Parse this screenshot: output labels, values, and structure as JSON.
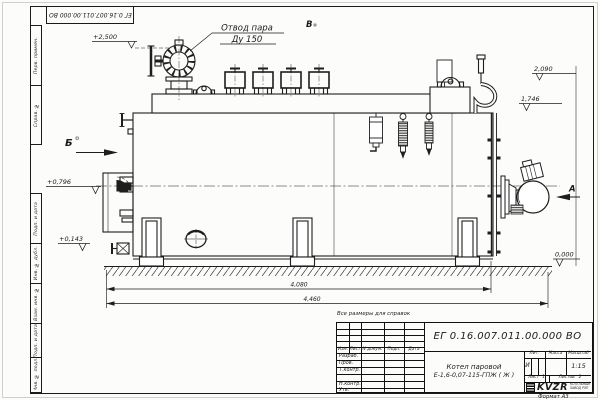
{
  "sheet": {
    "stamp_doc_number": "ЕГ 0.16.007.011.00.000  ВО",
    "reference_note": "Все размеры для справок",
    "format_label": "Формат А3"
  },
  "margin": {
    "col_top": [
      "Перв. примен.",
      "Справ. №"
    ],
    "col_bottom": [
      "Подп. и дата",
      "Инв. № дубл.",
      "Взам. инв. №",
      "Подп. и дата",
      "Инв. № подл."
    ]
  },
  "callout": {
    "line1": "Отвод пара",
    "line2": "Ду 150"
  },
  "views": {
    "b": "Б",
    "v": "В",
    "a": "А"
  },
  "elevations": {
    "valve_top": "+2,500",
    "dome_top": "2,090",
    "drum_top": "1,746",
    "door_axis": "+0,796",
    "low_point": "+0,143",
    "ground": "0,000"
  },
  "dimensions": {
    "boiler_length": "4,080",
    "overall_length": "4,460"
  },
  "title_block": {
    "doc_number": "ЕГ 0.16.007.011.00.000  ВО",
    "product_name": "Котел паровой",
    "product_code": "Е-1,6-0,07-115-ГПЖ ( Ж )",
    "change_header": [
      "Изм.",
      "Лист",
      "N докум.",
      "Подп.",
      "Дата"
    ],
    "sign_rows": [
      "Разраб.",
      "Пров.",
      "Т.контр.",
      "",
      "Н.контр.",
      "Утв."
    ],
    "lit_label": "Лит.",
    "lit_value": "И",
    "mass_label": "Масса",
    "scale_label": "Масштаб",
    "scale_value": "1:15",
    "sheet_label": "Лист",
    "sheet_num": "1",
    "sheets_label": "Листов",
    "sheets_num": "2",
    "logo_text": "KVZR",
    "company_line1": "КОТЕЛЬНЫЙ",
    "company_line2": "ЗАВОД РЭП"
  }
}
